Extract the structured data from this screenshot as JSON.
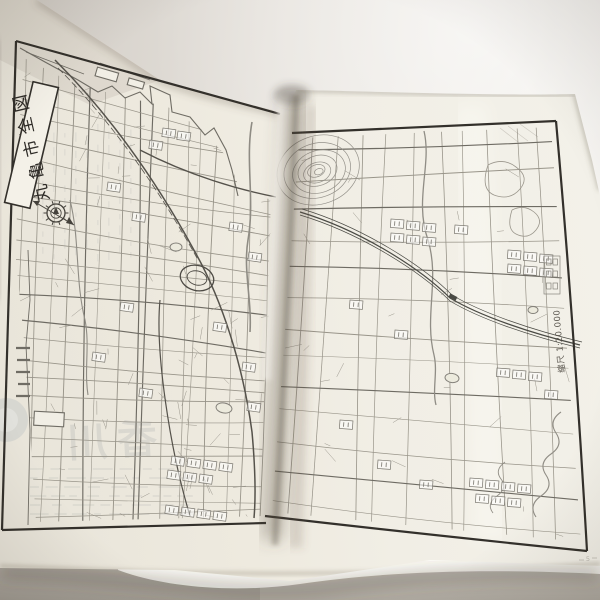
{
  "map": {
    "title": "丸亀市全図",
    "scale_label": "縮尺 1:20.000",
    "page_number": "5",
    "compass_icon": "north-arrow-icon"
  },
  "showthrough": {
    "brand_text": "香川"
  },
  "colors": {
    "paper": "#efebe0",
    "paper_bright": "#f3f1e9",
    "map_line": "#84817a",
    "map_border": "#33302b",
    "backdrop": "#e6e2dc",
    "surface": "#b2ada4",
    "showthrough_ink": "#667180"
  }
}
